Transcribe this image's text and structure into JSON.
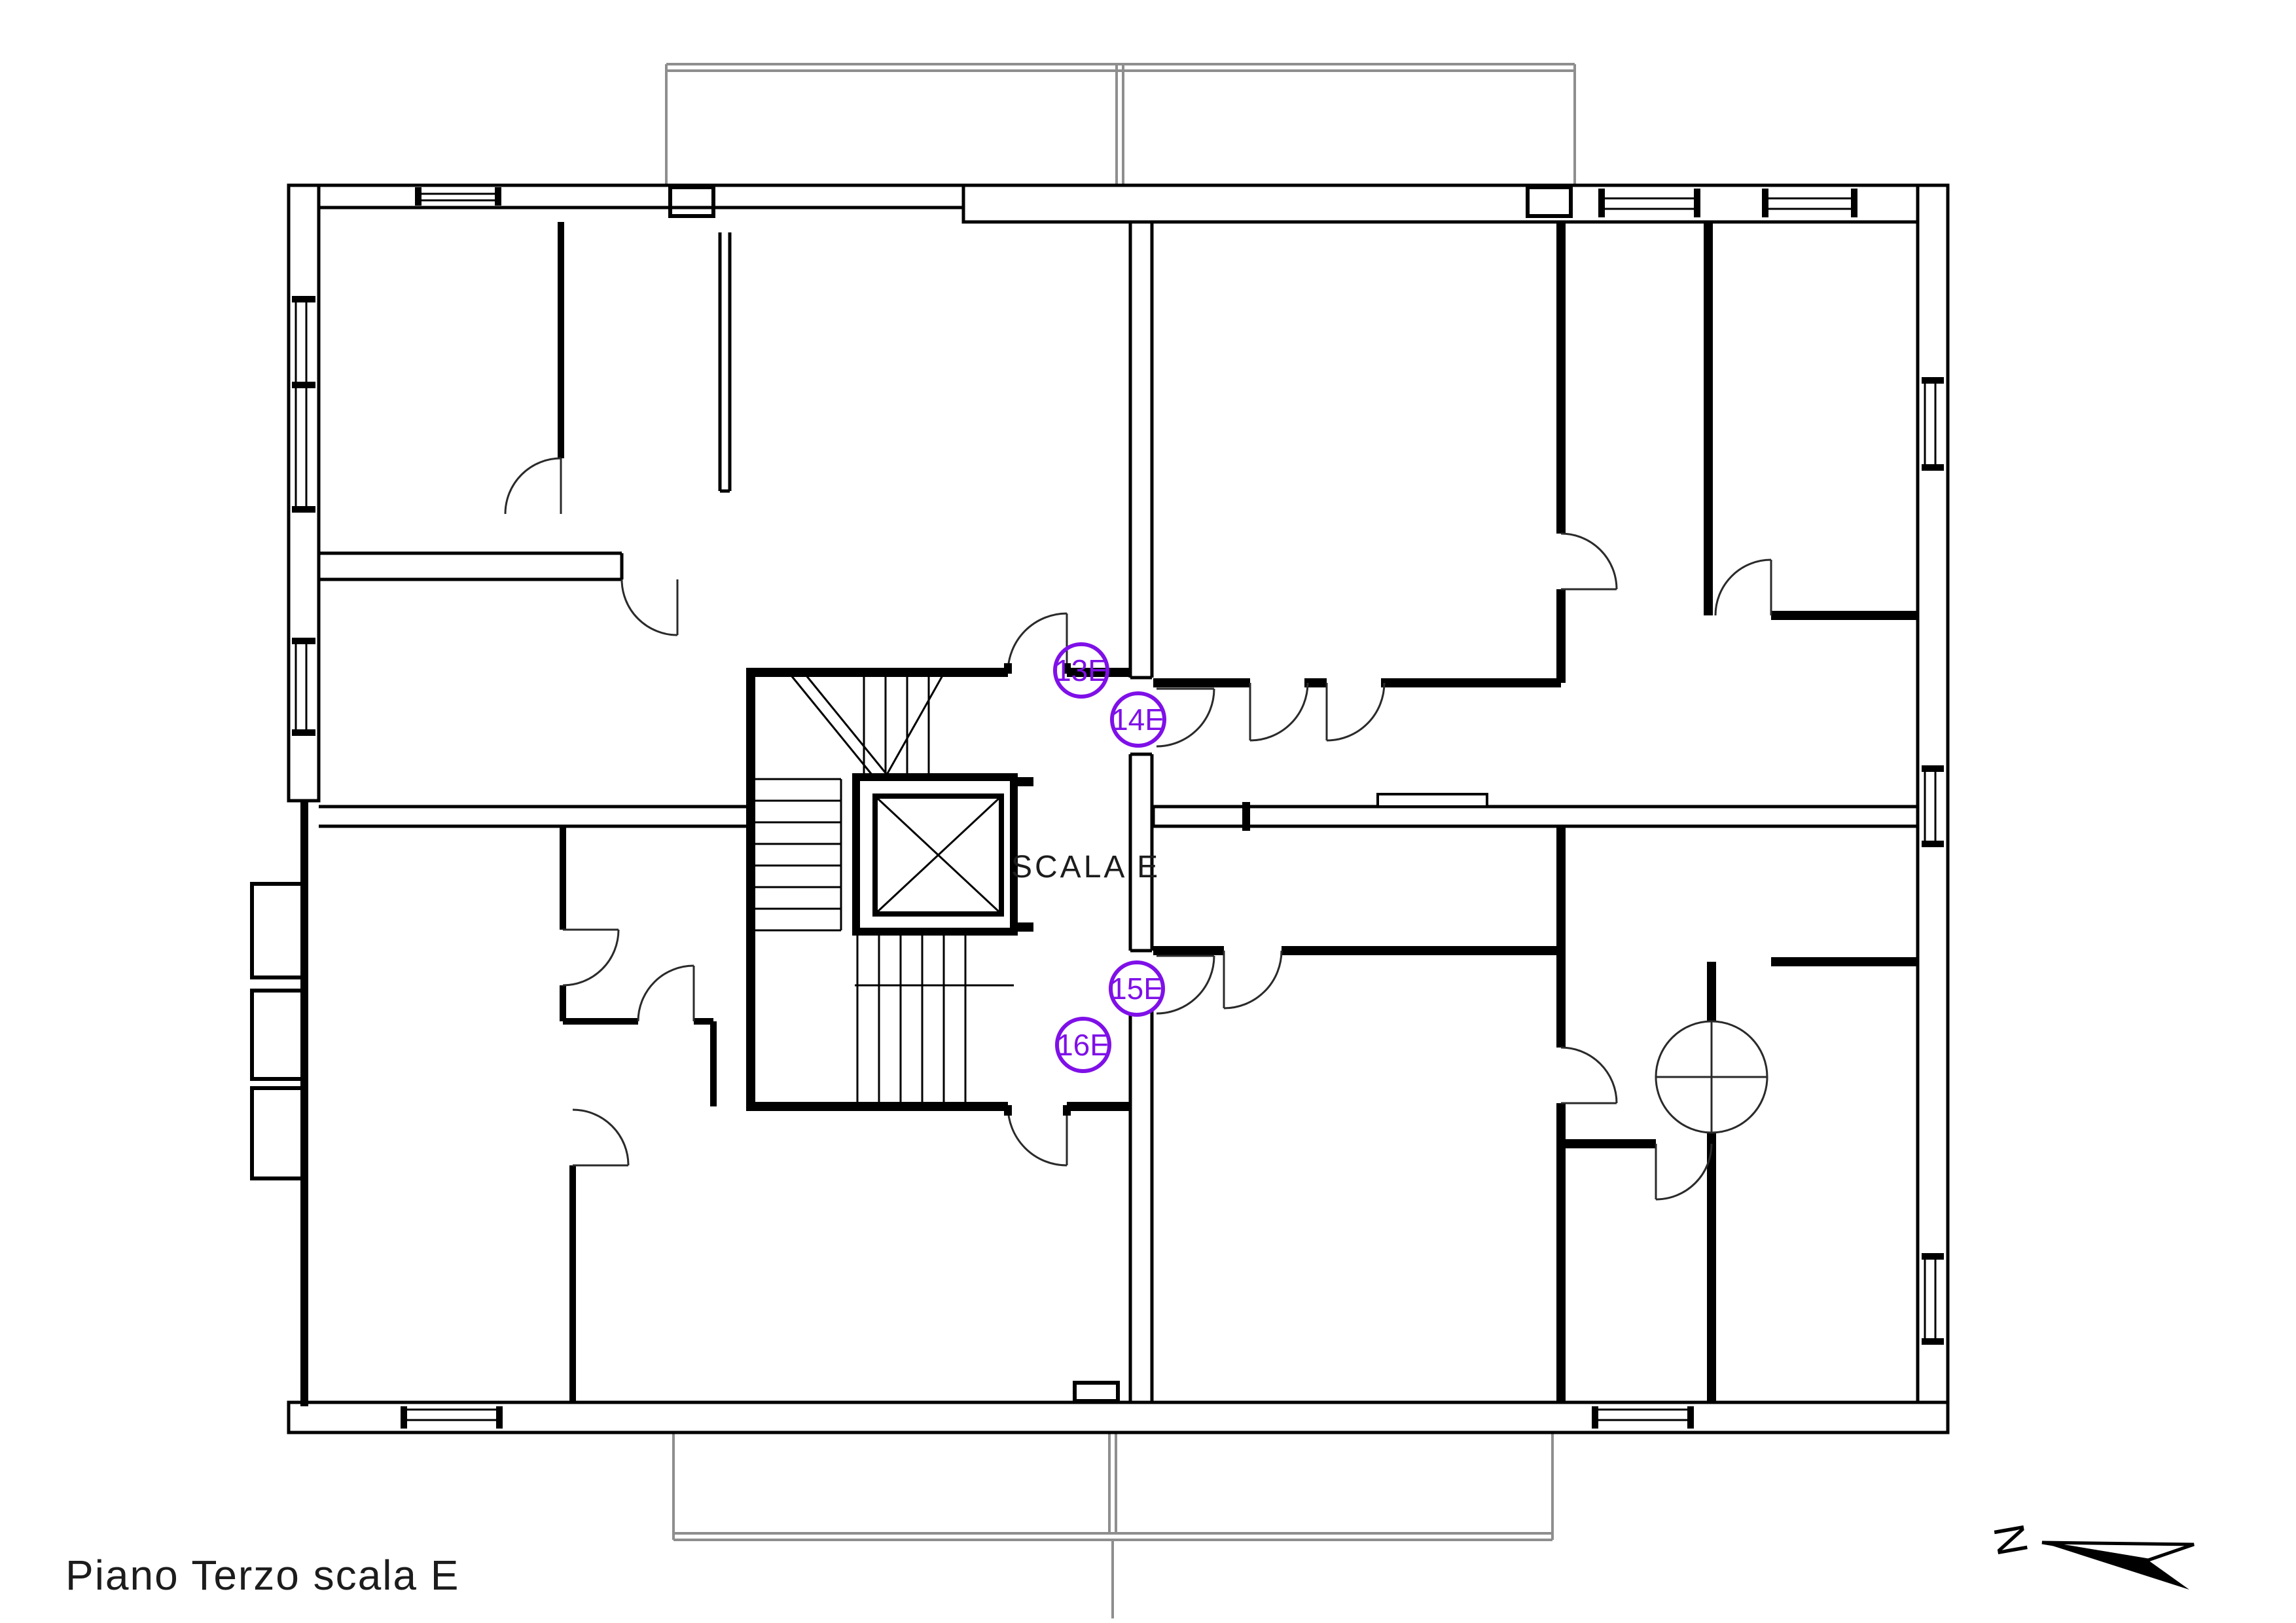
{
  "title": {
    "label": "Piano Terzo scala E"
  },
  "core": {
    "stair_label": "SCALA E"
  },
  "units": [
    {
      "id": "unit-13e",
      "label": "13E"
    },
    {
      "id": "unit-14e",
      "label": "14E"
    },
    {
      "id": "unit-15e",
      "label": "15E"
    },
    {
      "id": "unit-16e",
      "label": "16E"
    }
  ],
  "north_arrow": {
    "label": "N"
  },
  "colors": {
    "background": "#FFFFFF",
    "wall_black": "#000000",
    "accent_purple": "#7F10E8",
    "balcony_gray": "#8E8E8E",
    "text_dark": "#1C1C1C"
  }
}
